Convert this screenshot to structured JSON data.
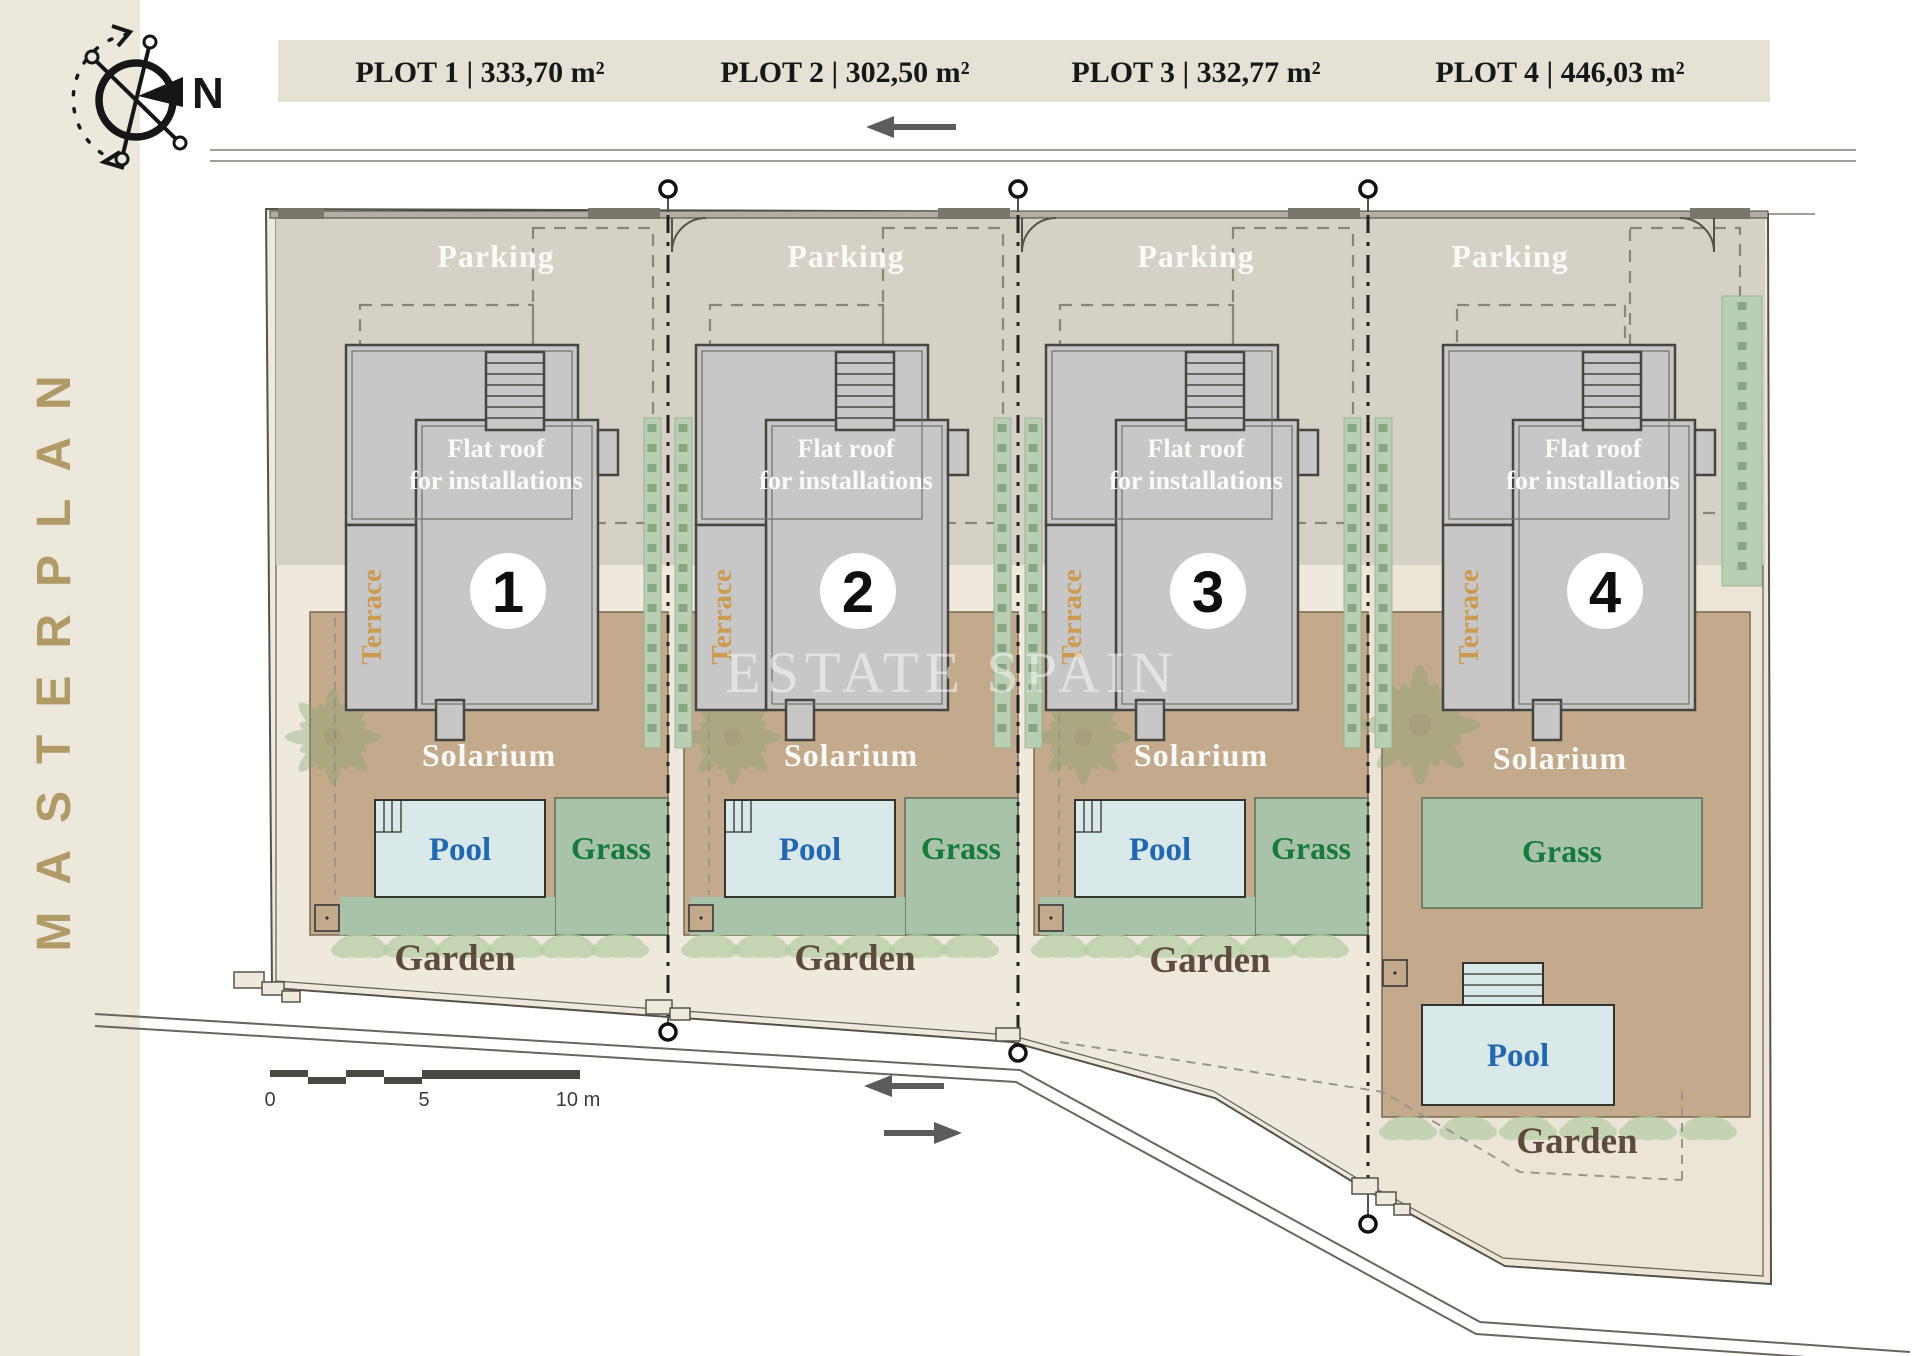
{
  "sidebar": {
    "title": "MASTERPLAN"
  },
  "compass": {
    "north_label": "N"
  },
  "header": {
    "items": [
      {
        "label": "PLOT 1 | 333,70 m²"
      },
      {
        "label": "PLOT 2 | 302,50 m²"
      },
      {
        "label": "PLOT 3 | 332,77 m²"
      },
      {
        "label": "PLOT 4 | 446,03 m²"
      }
    ]
  },
  "labels": {
    "parking": "Parking",
    "flat_roof_line1": "Flat roof",
    "flat_roof_line2": "for installations",
    "terrace": "Terrace",
    "solarium": "Solarium",
    "pool": "Pool",
    "grass": "Grass",
    "garden": "Garden"
  },
  "plots": [
    {
      "number": "1"
    },
    {
      "number": "2"
    },
    {
      "number": "3"
    },
    {
      "number": "4"
    }
  ],
  "scale_bar": {
    "tick_0": "0",
    "tick_5": "5",
    "tick_10": "10 m"
  },
  "watermark": "ESTATE SPAIN",
  "colors": {
    "sidebar_bg": "#ece8dc",
    "sidebar_text": "#b09a66",
    "header_bg": "#e6e1d5",
    "ground": "#efe9dd",
    "parking": "#d6d1c6",
    "building": "#c7c7c7",
    "solarium": "#c3aa8c",
    "pool_fill": "#d9e8e9",
    "pool_text": "#2268b0",
    "grass_fill": "#a8c3aa",
    "grass_text": "#167a3c",
    "garden_text": "#5d4b3e",
    "terrace_text": "#cd9a52",
    "hedge": "#b9cfb4"
  }
}
